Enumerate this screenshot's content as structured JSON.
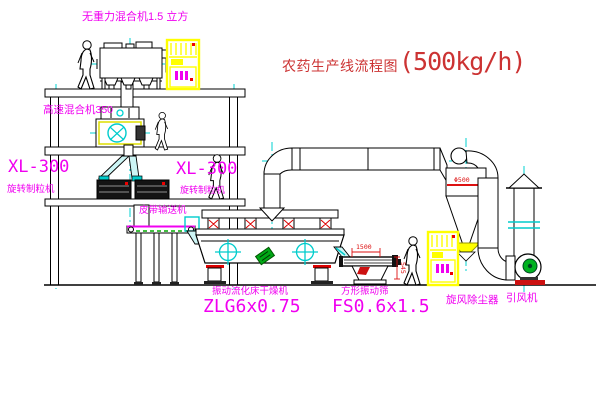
{
  "title": {
    "name": "农药生产线流程图",
    "capacity": "(500kg/h)"
  },
  "labels": {
    "gravity_mixer": "无重力混合机1.5 立方",
    "high_speed_mixer": "高速混合机350",
    "xl300_left": "XL-300",
    "rotary_granulator_left": "旋转制粒机",
    "xl300_right": "XL-300",
    "rotary_granulator_right": "旋转制粒机",
    "belt_conveyor": "皮带输送机",
    "fluid_bed_dryer_name": "振动流化床干燥机",
    "fluid_bed_dryer_model": "ZLG6x0.75",
    "square_sieve_name": "方形振动筛",
    "square_sieve_model": "FS0.6x1.5",
    "cyclone_dust_collector": "旋风除尘器",
    "induced_draft_fan": "引风机"
  },
  "dimensions": {
    "cyclone_diameter": "Φ500",
    "sieve_length": "1500",
    "sieve_height": "545"
  },
  "colors": {
    "label_magenta": "#f000f0",
    "title_red": "#cc3333",
    "dimension_red": "#dd1111",
    "cabinet_yellow": "#ffff00",
    "centerline_cyan": "#00d2d2",
    "motor_green": "#00b321",
    "line_black": "#000000"
  }
}
